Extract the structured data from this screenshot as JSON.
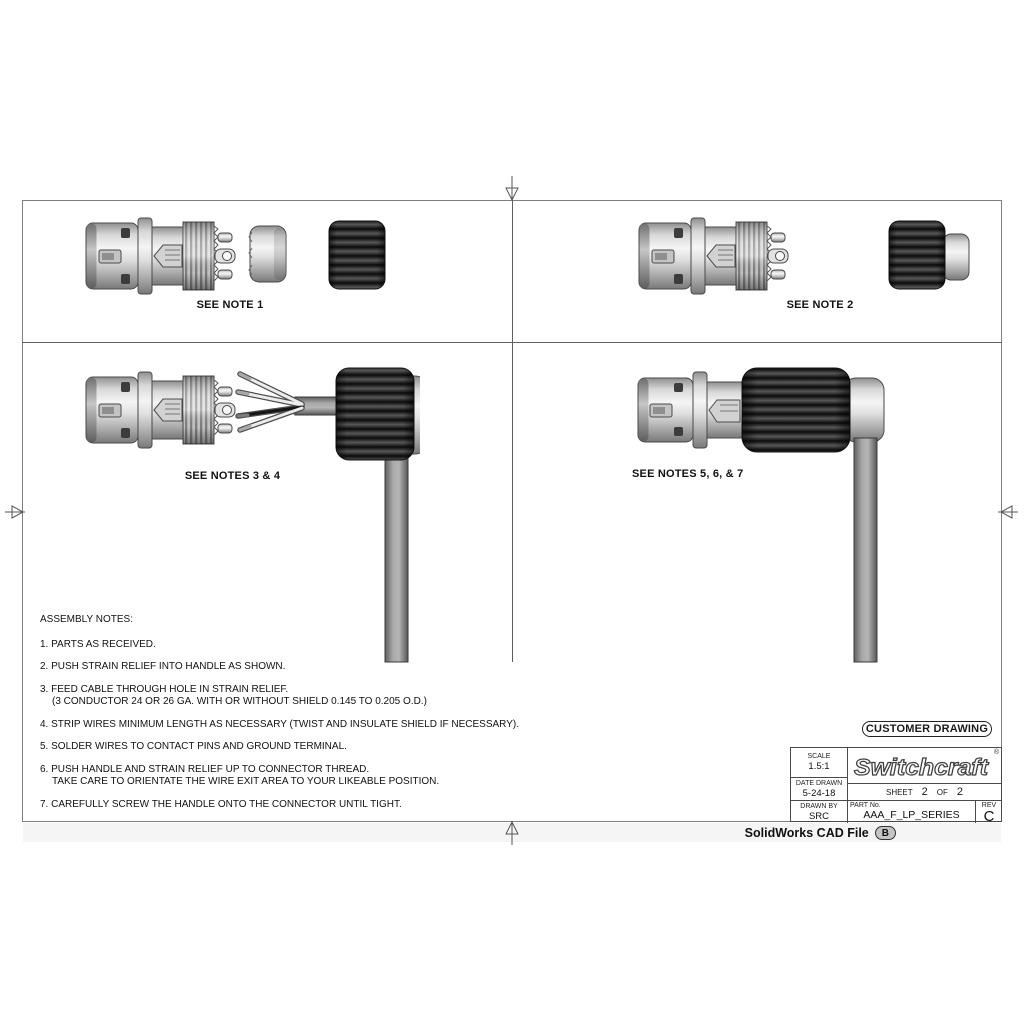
{
  "views": {
    "note1_label": "SEE NOTE 1",
    "note2_label": "SEE NOTE 2",
    "notes34_label": "SEE NOTES 3 & 4",
    "notes567_label": "SEE NOTES 5, 6, & 7"
  },
  "assembly_notes": {
    "title": "ASSEMBLY NOTES:",
    "lines": [
      "1. PARTS AS RECEIVED.",
      "2. PUSH STRAIN RELIEF INTO HANDLE AS SHOWN.",
      "3. FEED CABLE THROUGH HOLE IN STRAIN RELIEF.",
      "(3 CONDUCTOR 24 OR 26 GA. WITH OR WITHOUT SHIELD 0.145 TO 0.205 O.D.)",
      "4. STRIP WIRES MINIMUM LENGTH AS NECESSARY (TWIST AND INSULATE SHIELD IF NECESSARY).",
      "5. SOLDER WIRES TO CONTACT PINS AND GROUND TERMINAL.",
      "6. PUSH HANDLE AND STRAIN RELIEF UP TO CONNECTOR THREAD.",
      "TAKE CARE TO ORIENTATE THE WIRE EXIT AREA TO YOUR LIKEABLE POSITION.",
      "7. CAREFULLY SCREW THE HANDLE ONTO THE CONNECTOR UNTIL TIGHT."
    ]
  },
  "title_block": {
    "customer_drawing_label": "CUSTOMER DRAWING",
    "scale_label": "SCALE",
    "scale_value": "1.5:1",
    "date_drawn_label": "DATE DRAWN",
    "date_drawn_value": "5-24-18",
    "drawn_by_label": "DRAWN BY",
    "drawn_by_value": "SRC",
    "brand_name": "Switchcraft",
    "brand_registered_mark": "®",
    "sheet_label": "SHEET",
    "sheet_number": "2",
    "of_label": "OF",
    "sheet_total": "2",
    "part_no_label": "PART No.",
    "part_no_value": "AAA_F_LP_SERIES",
    "rev_label": "REV",
    "rev_value": "C"
  },
  "footer": {
    "cad_file_label": "SolidWorks CAD File",
    "cad_revision_badge": "B"
  },
  "colors": {
    "frame_line": "#7f7f7f",
    "divider_line": "#5f5f5f",
    "text": "#111111",
    "handle_black": "#1c1c1c",
    "metal_light": "#e8e8e8",
    "cable_gray": "#8a8a8a",
    "badge_fill": "#c4c4c4"
  }
}
